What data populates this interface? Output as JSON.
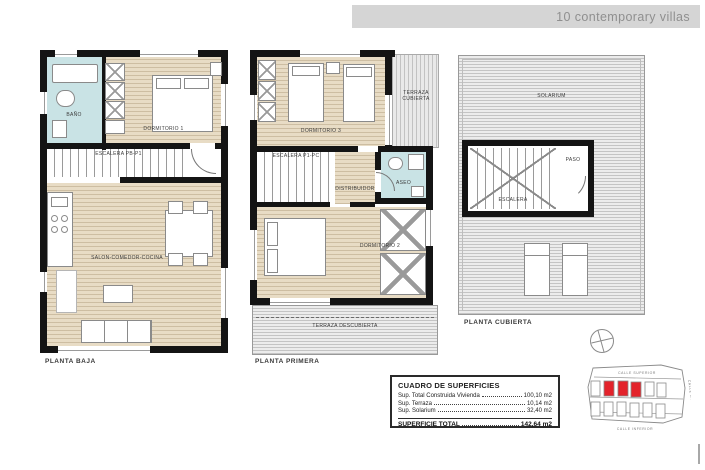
{
  "header": {
    "title": "10 contemporary villas"
  },
  "colors": {
    "accent_red": "#e3232b",
    "wood_floor": "#e8dcc5",
    "bath_blue": "#c9e3e5",
    "wall_black": "#141414",
    "header_bar_bg": "#d5d5d5",
    "header_text": "#8f8f8f"
  },
  "plans": {
    "baja": {
      "label": "PLANTA BAJA",
      "rooms": {
        "bano": "BAÑO",
        "dormitorio1": "DORMITORIO 1",
        "escalera": "ESCALERA PB-P1",
        "salon": "SALON-COMEDOR-COCINA"
      }
    },
    "primera": {
      "label": "PLANTA PRIMERA",
      "rooms": {
        "dormitorio3": "DORMITORIO 3",
        "terraza_cubierta": "TERRAZA CUBIERTA",
        "escalera": "ESCALERA P1-PC",
        "distribuidor": "DISTRIBUIDOR",
        "aseo": "ASEO",
        "dormitorio2": "DORMITORIO 2",
        "terraza_descubierta": "TERRAZA DESCUBIERTA"
      }
    },
    "cubierta": {
      "label": "PLANTA CUBIERTA",
      "rooms": {
        "solarium": "SOLARIUM",
        "paso": "PASO",
        "escalera": "ESCALERA"
      }
    }
  },
  "surface_table": {
    "title": "CUADRO DE SUPERFICIES",
    "rows": [
      {
        "label": "Sup. Total Construida Vivienda",
        "value": "100,10 m2"
      },
      {
        "label": "Sup. Terraza",
        "value": "10,14 m2"
      },
      {
        "label": "Sup. Solarium",
        "value": "32,40 m2"
      }
    ],
    "total_label": "SUPERFICIE TOTAL",
    "total_value": "142,64 m2"
  },
  "site_plan": {
    "street_top": "CALLE SUPERIOR",
    "street_bottom": "CALLE INFERIOR",
    "street_right": "CALLE LATERAL"
  }
}
